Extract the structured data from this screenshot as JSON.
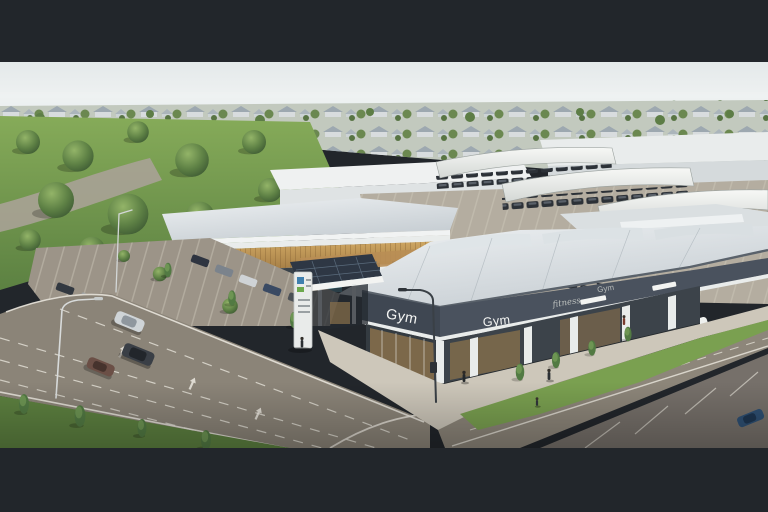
{
  "meta": {
    "type": "architectural-aerial-render",
    "description": "Aerial artist's impression of a suburban retail development: a gym building with shopfronts in the foreground, a timber-clad childcare centre, supermarket buildings with canopied car parking, boulevard roads with traffic, parkland and a housing estate on the horizon"
  },
  "signs": {
    "gym_left": "Gym",
    "gym_front": "Gym",
    "fitness_script": "fitness",
    "gym_far": "Gym"
  },
  "colors": {
    "letterbox": "#22262b",
    "sign_text": "#f5f6f4",
    "sign_faded": "#c9ccc8",
    "fascia": "#3f4752",
    "fascia_right": "#4a525e",
    "grass": "#7aa050",
    "grass_dark": "#5d8140",
    "road": "#8b8478",
    "marking": "#ece9e0",
    "canopy": "#f3f4f2",
    "timber": "#c49a5c",
    "glass_warm": "#8a714c",
    "concrete": "#cdc7ba",
    "car_dark": "#2f343a",
    "building_white": "#e9eceb"
  }
}
